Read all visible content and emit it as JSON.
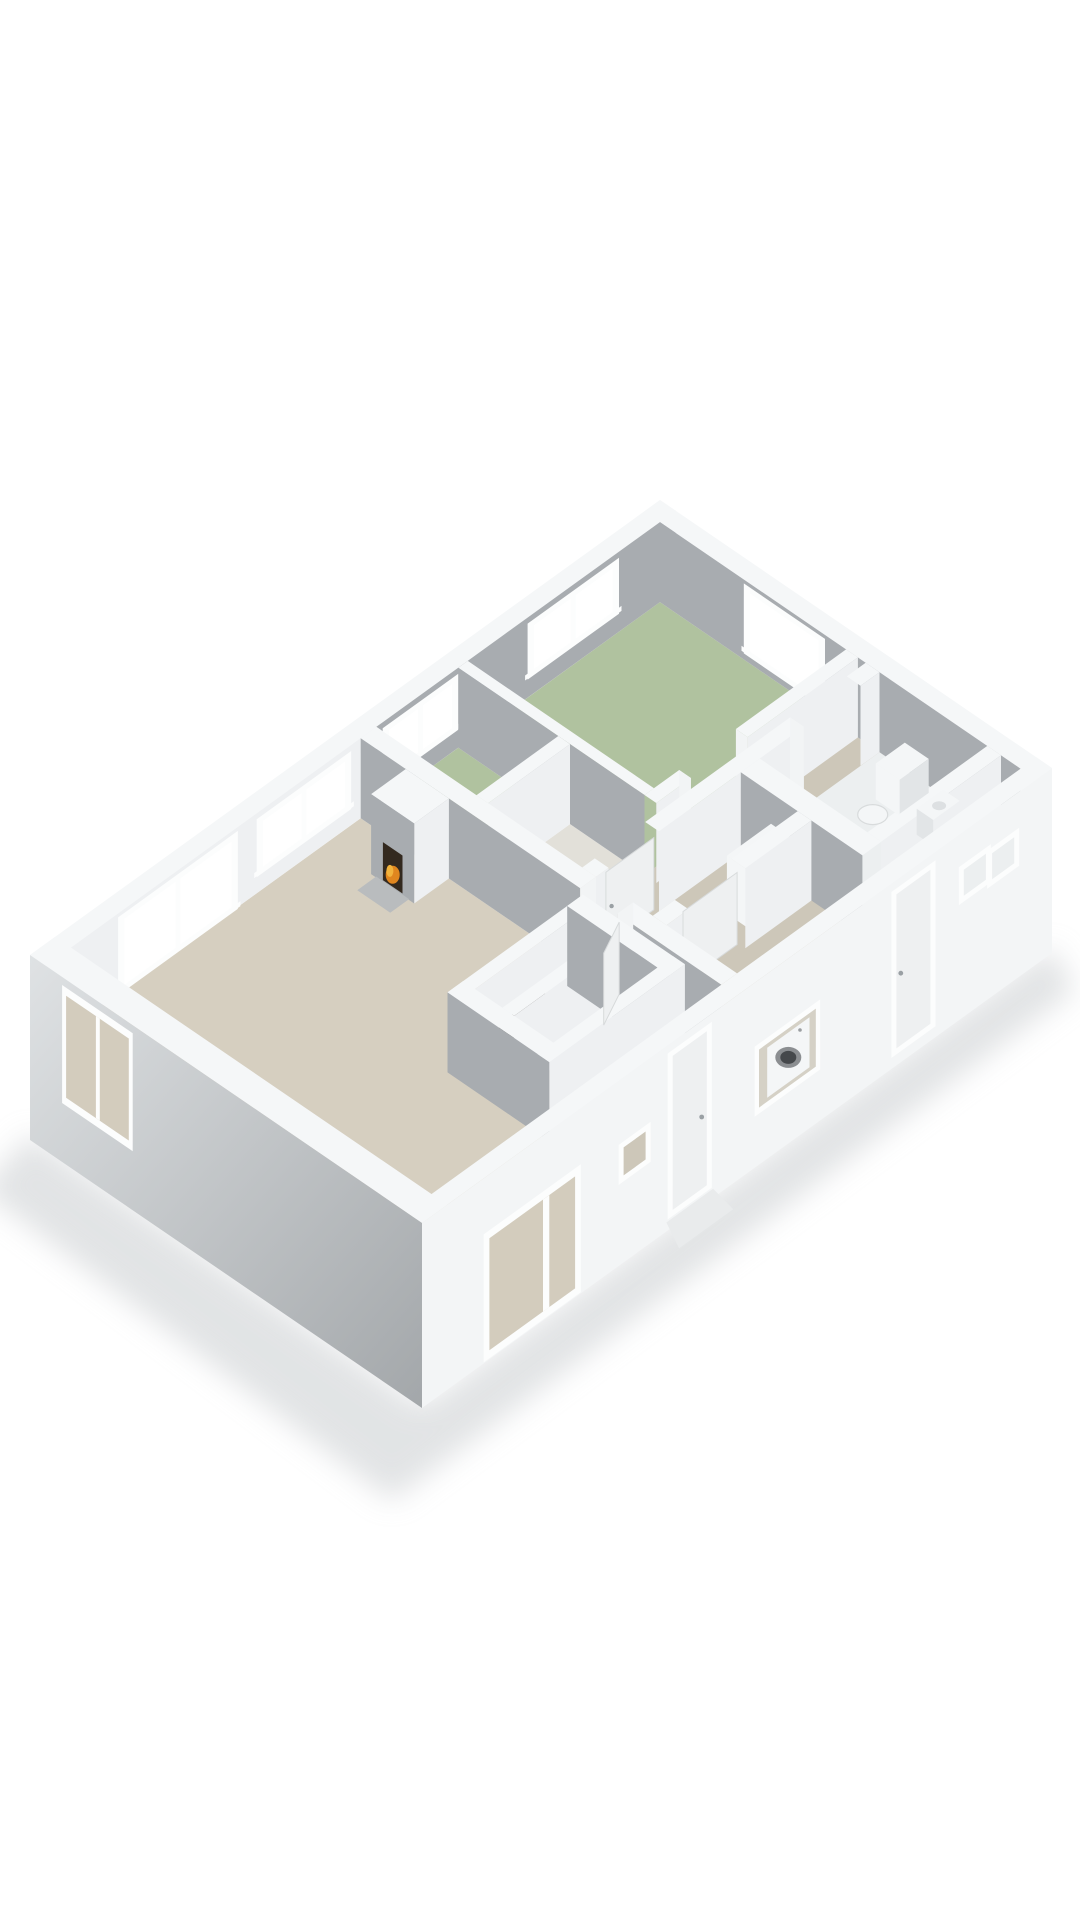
{
  "scene": {
    "kind": "isometric-3d-floor-plan",
    "background": "#ffffff"
  },
  "colors": {
    "floor_living": "#d6cfc0",
    "floor_bedroom": "#b0c29f",
    "floor_hall": "#cdc7b9",
    "floor_bath": "#e2e0d9",
    "floor_toilet": "#eceff0",
    "floor_closet": "#c6c0b2",
    "wall_top": "#f5f7f8",
    "face_gray": "#a8acb0",
    "face_light": "#eef0f2",
    "face_cap": "#f2f4f5",
    "outer_near": "#f3f5f6",
    "outer_left_hi": "#dfe2e4",
    "outer_left_lo": "#a3a7aa",
    "frame": "#fcfdfd",
    "glass_out": "#ffffff",
    "door_panel": "#eef0f1",
    "fixture": "#f4f6f7",
    "fixture_shade": "#e2e5e7",
    "washer_ring": "#8b8e91",
    "washer_dark": "#45484b",
    "fire_dark": "#33291f",
    "flame1": "#e0861f",
    "flame2": "#f2b33d",
    "heater_dark": "#3c3733",
    "heater_glow": "#cf7a2a",
    "shadow": "#caced0",
    "handle": "#9aa0a4"
  },
  "rooms": [
    {
      "id": "bedroom-1",
      "floor": "floor_bedroom"
    },
    {
      "id": "bedroom-2",
      "floor": "floor_bedroom"
    },
    {
      "id": "bathroom",
      "floor": "floor_bath"
    },
    {
      "id": "hallway",
      "floor": "floor_hall"
    },
    {
      "id": "toilet-room",
      "floor": "floor_toilet"
    },
    {
      "id": "utility-room",
      "floor": "floor_hall"
    },
    {
      "id": "living-room",
      "floor": "floor_living"
    },
    {
      "id": "entry",
      "floor": "floor_hall"
    },
    {
      "id": "closet",
      "floor": "floor_closet"
    }
  ],
  "fixtures": [
    "fireplace",
    "toilet",
    "hand-basin",
    "boiler-unit",
    "washing-machine",
    "heater-unit",
    "front-door",
    "back-door",
    "door-step"
  ]
}
